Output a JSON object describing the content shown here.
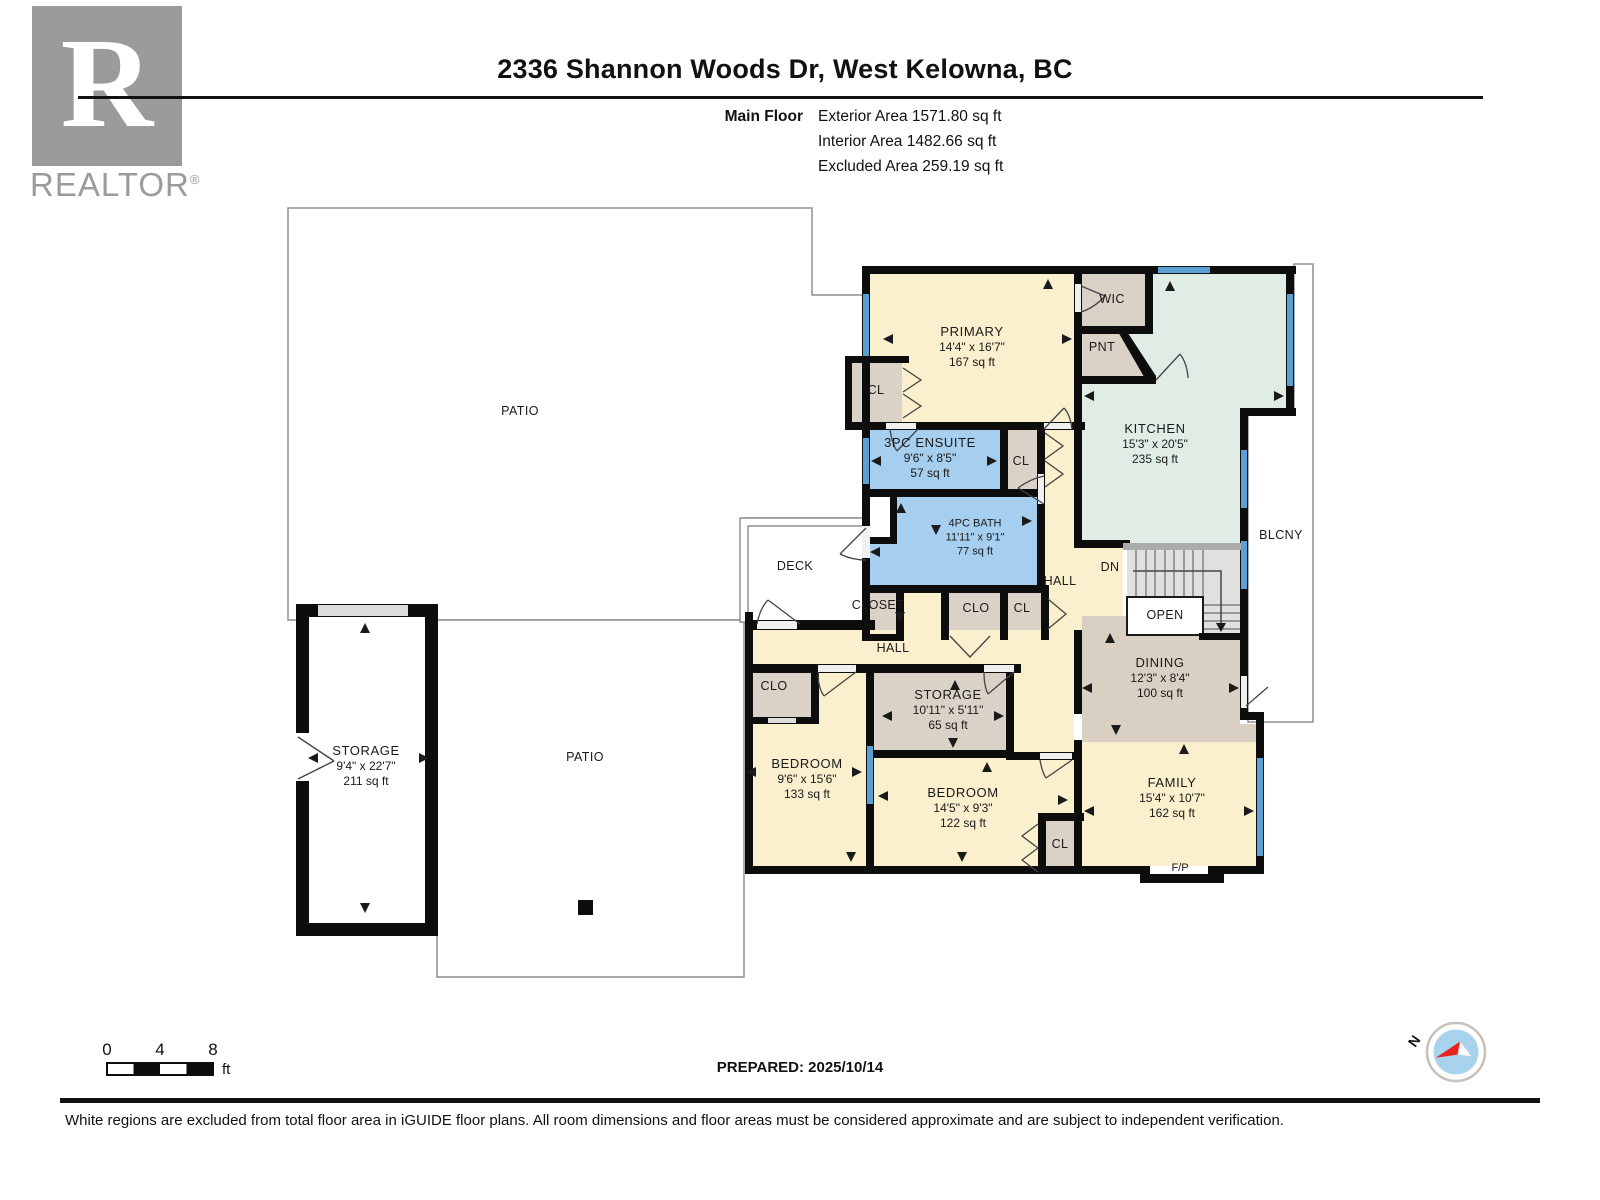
{
  "header": {
    "title": "2336 Shannon Woods Dr, West Kelowna, BC",
    "floor_label": "Main Floor",
    "area_lines": [
      "Exterior Area 1571.80 sq ft",
      "Interior Area 1482.66 sq ft",
      "Excluded Area 259.19 sq ft"
    ]
  },
  "logo": {
    "letter": "R",
    "word": "REALTOR",
    "registered": "®"
  },
  "rooms": {
    "primary": {
      "name": "PRIMARY",
      "dims": "14'4\" x 16'7\"",
      "area": "167 sq ft"
    },
    "ensuite": {
      "name": "3PC ENSUITE",
      "dims": "9'6\" x 8'5\"",
      "area": "57 sq ft"
    },
    "bath": {
      "name": "4PC BATH",
      "dims": "11'11\" x 9'1\"",
      "area": "77 sq ft"
    },
    "kitchen": {
      "name": "KITCHEN",
      "dims": "15'3\" x 20'5\"",
      "area": "235 sq ft"
    },
    "dining": {
      "name": "DINING",
      "dims": "12'3\" x 8'4\"",
      "area": "100 sq ft"
    },
    "family": {
      "name": "FAMILY",
      "dims": "15'4\" x 10'7\"",
      "area": "162 sq ft"
    },
    "bedroom1": {
      "name": "BEDROOM",
      "dims": "9'6\" x 15'6\"",
      "area": "133 sq ft"
    },
    "bedroom2": {
      "name": "BEDROOM",
      "dims": "14'5\" x 9'3\"",
      "area": "122 sq ft"
    },
    "storage_mid": {
      "name": "STORAGE",
      "dims": "10'11\" x 5'11\"",
      "area": "65 sq ft"
    },
    "storage_left": {
      "name": "STORAGE",
      "dims": "9'4\" x 22'7\"",
      "area": "211 sq ft"
    }
  },
  "labels": {
    "wic": "WIC",
    "pnt": "PNT",
    "cl": "CL",
    "clo": "CLO",
    "closet": "CLOSET",
    "hall": "HALL",
    "dn": "DN",
    "open": "OPEN",
    "deck": "DECK",
    "blcny": "BLCNY",
    "patio": "PATIO",
    "fp": "F/P"
  },
  "scale_bar": {
    "ticks": [
      "0",
      "4",
      "8"
    ],
    "unit": "ft"
  },
  "prepared": "PREPARED: 2025/10/14",
  "compass": {
    "north": "N"
  },
  "footer": {
    "disclaimer": "White regions are excluded from total floor area in iGUIDE floor plans. All room dimensions and floor areas must be considered approximate and are subject to independent verification."
  }
}
